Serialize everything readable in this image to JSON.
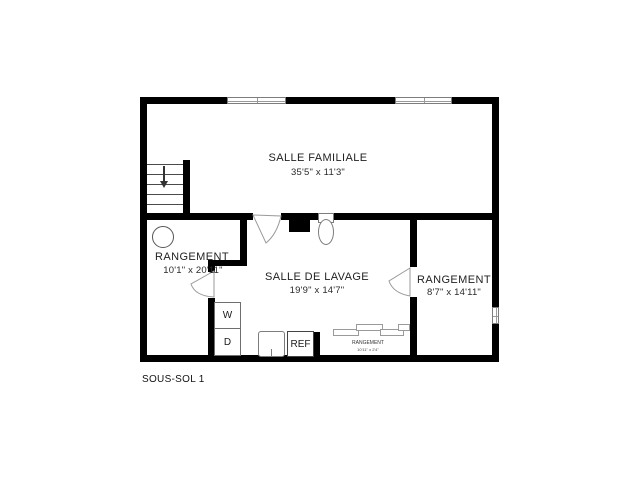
{
  "title": {
    "caption": "SOUS-SOL 1"
  },
  "rooms": {
    "familiale": {
      "name": "SALLE FAMILIALE",
      "dims": "35'5\" x 11'3\""
    },
    "rangement_left": {
      "name": "RANGEMENT",
      "dims": "10'1\" x 20'11\""
    },
    "lavage": {
      "name": "SALLE DE LAVAGE",
      "dims": "19'9\" x 14'7\""
    },
    "rangement_right": {
      "name": "RANGEMENT",
      "dims": "8'7\" x 14'11\""
    },
    "rangement_closet": {
      "name": "RANGEMENT",
      "dims": "10'11\" x 2'4\""
    }
  },
  "appliances": {
    "washer": "W",
    "dryer": "D",
    "fridge": "REF"
  },
  "colors": {
    "wall": "#000000",
    "background": "#ffffff",
    "fixture_line": "#7d7d7d",
    "text": "#1f1f1f"
  }
}
